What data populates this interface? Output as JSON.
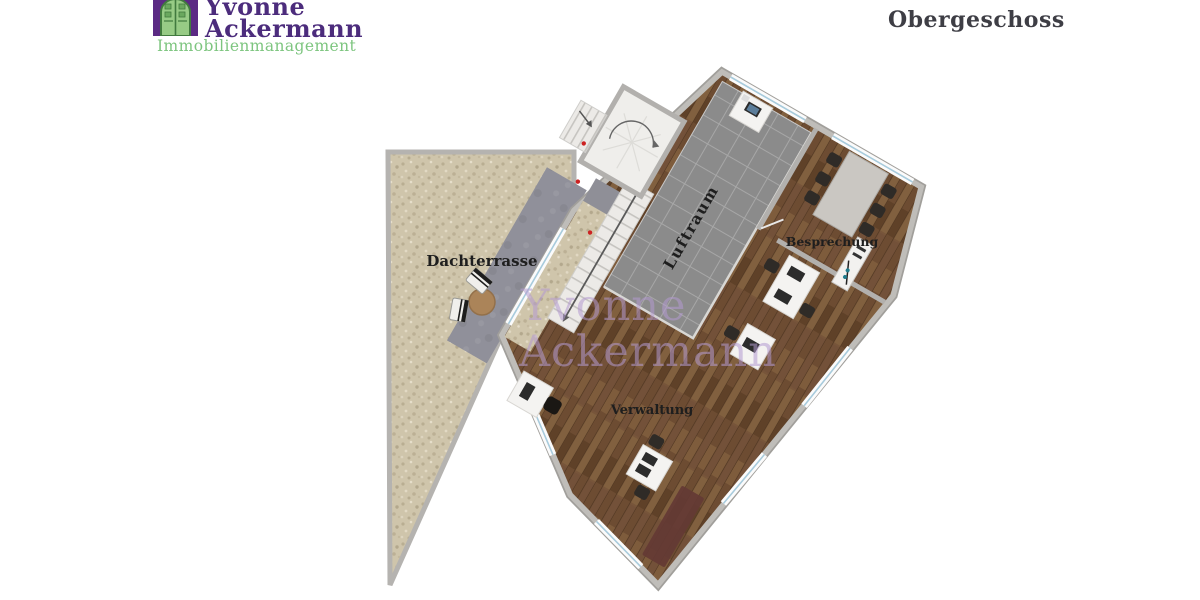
{
  "header": {
    "logo": {
      "icon": "building-door-icon",
      "name_line1": "Yvonne",
      "name_line2": "Ackermann",
      "subtitle": "Immobilienmanagement",
      "name_color": "#4c2c7c",
      "subtitle_color": "#7dc57f",
      "icon_bg_color": "#5b2a84",
      "icon_door_color": "#97cb85"
    },
    "title": "Obergeschoss",
    "title_color": "#3e3e45"
  },
  "plan": {
    "floor_name": "Obergeschoss",
    "labels": {
      "terrace": "Dachterrasse",
      "air_space": "Luftraum",
      "meeting": "Besprechung",
      "administration": "Verwaltung"
    },
    "rooms": [
      {
        "label": "Dachterrasse",
        "floor": "gravel terrace"
      },
      {
        "label": "Luftraum",
        "floor": "gray tiles (void over lower floor)"
      },
      {
        "label": "Besprechung",
        "floor": "wood, conference table with 6 chairs"
      },
      {
        "label": "Verwaltung",
        "floor": "wood, office desks with monitors and chairs"
      }
    ],
    "features": [
      "spiral-staircase",
      "straight-staircase",
      "entry-steps-arrow",
      "stone-walkway",
      "terrace-round-table-with-2-chairs",
      "sideboard",
      "dark-red-rug"
    ],
    "colors": {
      "gravel": "#cfc5ab",
      "wood_floor": "#77553a",
      "tiles": "#8b8b8b",
      "wall": "#b2b0ad",
      "stone_path": "#90909a",
      "stairs": "#eceae7",
      "conference_table": "#cac7c2",
      "desk": "#f4f3f1",
      "chair": "#2f2b27",
      "rug": "#643a34",
      "window_glass": "#a8cbdc",
      "door_marker_red": "#cc2222",
      "sideboard_dot_teal": "#1f7b8c"
    },
    "label_color": "#1e1e1e"
  },
  "watermark": {
    "line1": "Yvonne",
    "line2": "Ackermann",
    "color": "#b49bd1"
  }
}
